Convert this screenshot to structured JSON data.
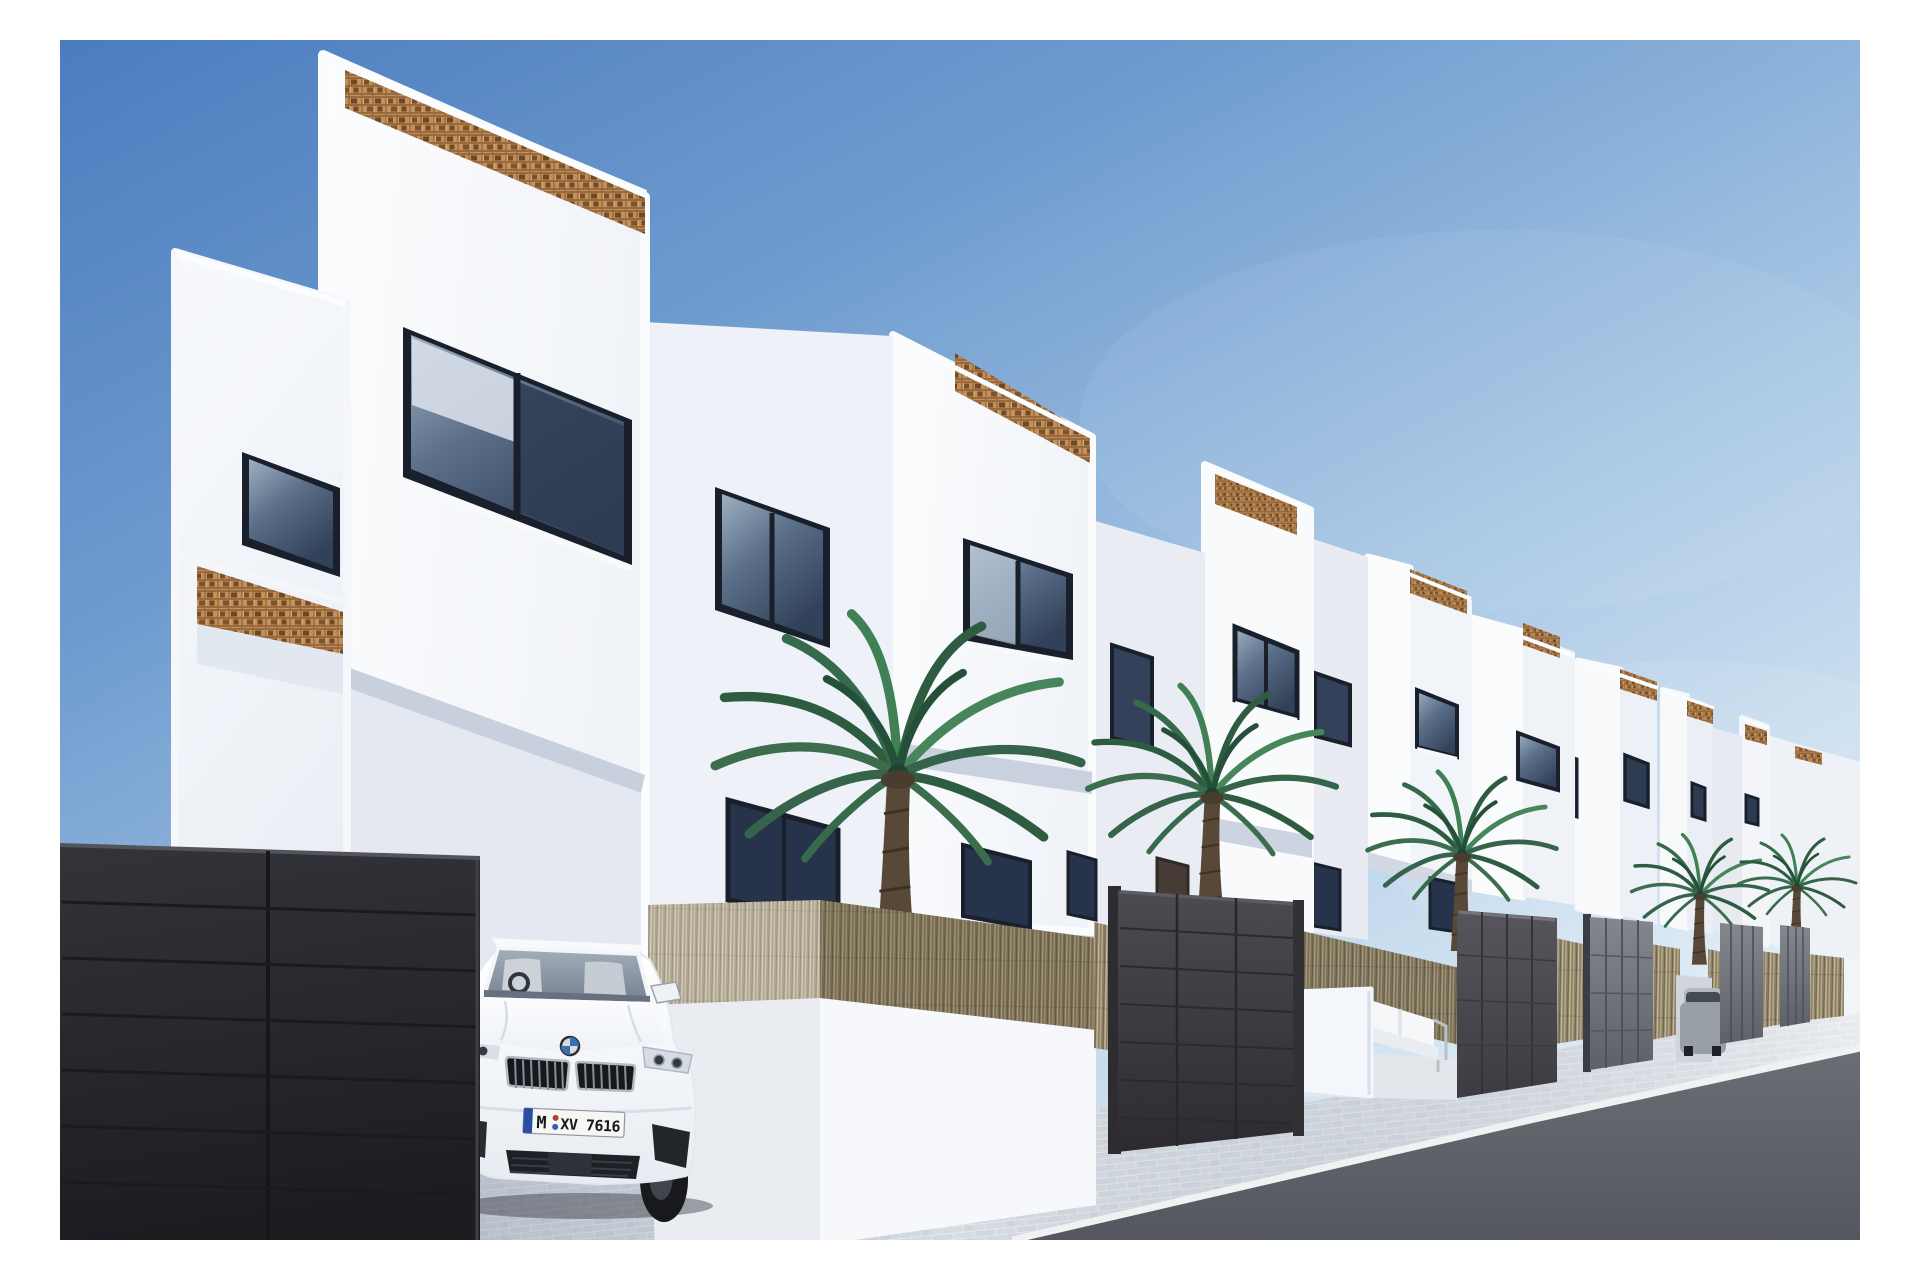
{
  "scene": {
    "kind": "3D exterior architectural rendering",
    "subject": "Row of new-build white modern townhouses along a street under a clear blue sky",
    "time_of_day": "bright sunny daylight",
    "elements": [
      "eight receding white townhouse volumes with rounded parapet corners",
      "terracotta breeze-block lattice screens on parapets",
      "dark framed windows",
      "natural reed (brezo) screening on white garden walls",
      "dark panelled privacy gates",
      "white parked BMW SUV",
      "grey car parked behind a far driveway gate",
      "five palm trees",
      "white outdoor sofa on a cobbled patio",
      "light cobblestone sidewalk and dark asphalt road"
    ]
  },
  "counts": {
    "townhouses": 8,
    "palm_trees": 5,
    "entry_gates": 5,
    "foreground_gates": 1,
    "cars": 2
  },
  "car": {
    "brand": "BMW",
    "description": "white BMW SUV parked facing the street",
    "plate": {
      "prefix": "M",
      "number": "XV 7616",
      "full": "M XV 7616",
      "band": "blue EU band",
      "seals": "two round registration seals"
    }
  },
  "furniture": {
    "patio_sofa": "white outdoor sofa with thin metal frame"
  },
  "colors": {
    "sky_top": "#4b7cbe",
    "sky_mid": "#6f9ccf",
    "sky_low": "#a9c8e5",
    "sky_horizon": "#e7f1f8",
    "wall_bright": "#fbfcfe",
    "wall_shade": "#e6ebf3",
    "lattice_base": "#c3905a",
    "lattice_dark": "#74512c",
    "reed_base": "#a2967c",
    "cobble_mortar": "#e8ebee",
    "road_top": "#6b6e74",
    "road_bottom": "#54575f",
    "gate_foreground_top": "#33333a",
    "gate_foreground_bottom": "#1c1c21",
    "gate_grey": "#6d7077",
    "window_frame": "#1a202b",
    "glass_dark": "#2e3c52",
    "palm_green": "#3c6e4e",
    "trunk_brown": "#584838",
    "car_white": "#f8fafc",
    "plate_blue": "#2a4da5",
    "plate_text": "#17181a"
  }
}
